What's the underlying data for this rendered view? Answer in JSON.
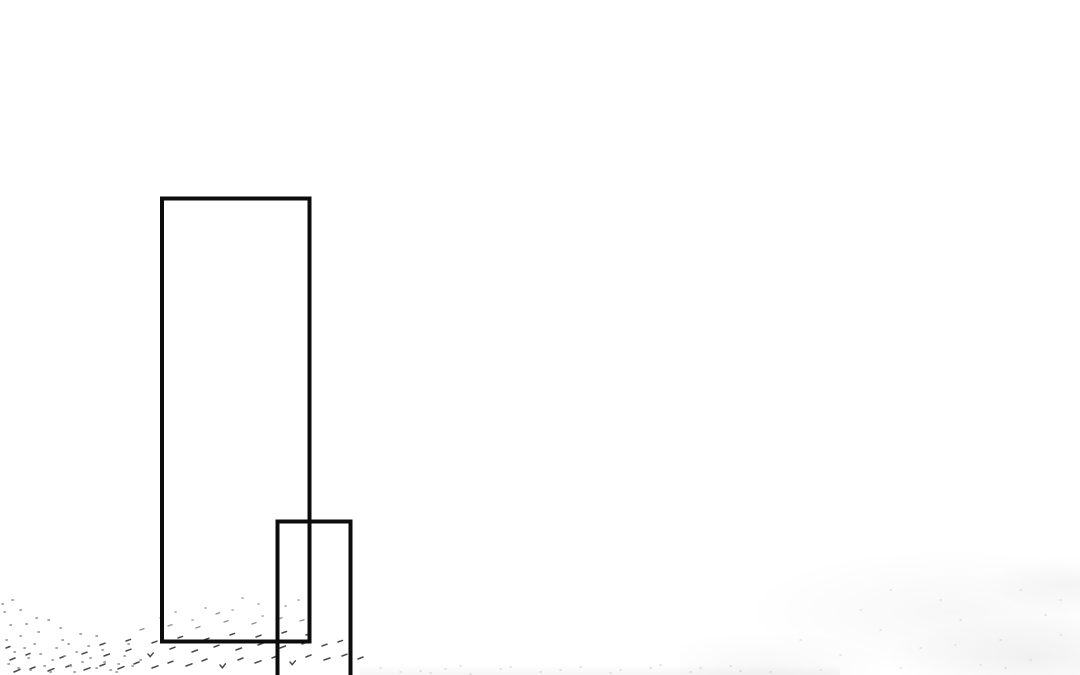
{
  "page": {
    "kind": "comic-page-fragment",
    "background_color": "#ffffff"
  },
  "artwork": {
    "ink_color": "#0c0c0c",
    "panel_fill": "none",
    "panels": [
      {
        "id": "tall-panel",
        "shape": "rectangle-outline"
      },
      {
        "id": "small-panel",
        "shape": "rectangle-outline-cropped-at-bottom"
      }
    ],
    "texture": {
      "hatch_color": "#4a4a4a",
      "hatch_light_color": "#8f8f8f",
      "dot_light_color": "#a8a8a8",
      "stipple_color": "#9a9a9a",
      "faint_color": "#d9d9d9"
    }
  }
}
